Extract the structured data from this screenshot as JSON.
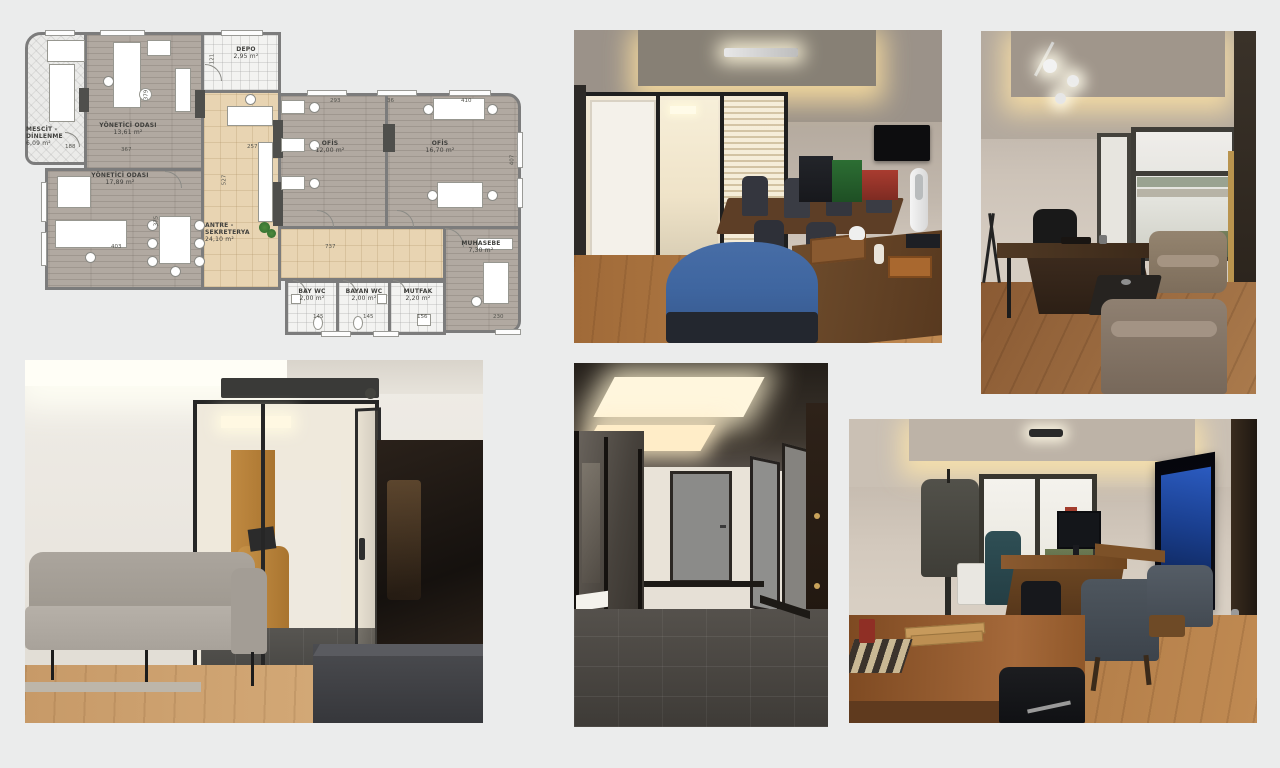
{
  "page": {
    "background": "#ebecec"
  },
  "floorplan": {
    "rooms": [
      {
        "name": "MESCİT - DİNLENME",
        "area": "6,09 m²"
      },
      {
        "name": "YÖNETİCİ ODASI",
        "area": "13,61 m²"
      },
      {
        "name": "DEPO",
        "area": "2,95 m²"
      },
      {
        "name": "YÖNETİCİ ODASI",
        "area": "17,89 m²"
      },
      {
        "name": "ANTRE - SEKRETERYA",
        "area": "24,10 m²"
      },
      {
        "name": "OFİS",
        "area": "12,00 m²"
      },
      {
        "name": "OFİS",
        "area": "16,70 m²"
      },
      {
        "name": "MUHASEBE",
        "area": "7,30 m²"
      },
      {
        "name": "BAY WC",
        "area": "2,00 m²"
      },
      {
        "name": "BAYAN WC",
        "area": "2,00 m²"
      },
      {
        "name": "MUTFAK",
        "area": "2,20 m²"
      }
    ],
    "dims": [
      "293",
      "36",
      "410",
      "367",
      "257",
      "737",
      "145",
      "145",
      "156",
      "230",
      "121",
      "527",
      "407",
      "375",
      "379",
      "403",
      "188"
    ]
  },
  "photos": [
    {
      "id": "meeting-room"
    },
    {
      "id": "executive-office"
    },
    {
      "id": "lounge-reception"
    },
    {
      "id": "corridor"
    },
    {
      "id": "office-with-tv"
    }
  ],
  "colors": {
    "wall_gray": "#7c7c7c",
    "wood_floor_plan": "#b1a9a1",
    "tile_beige": "#e8d4b2",
    "accent_blue_chair": "#3f66a0",
    "photo_wood_floor": "#b07a4a"
  }
}
